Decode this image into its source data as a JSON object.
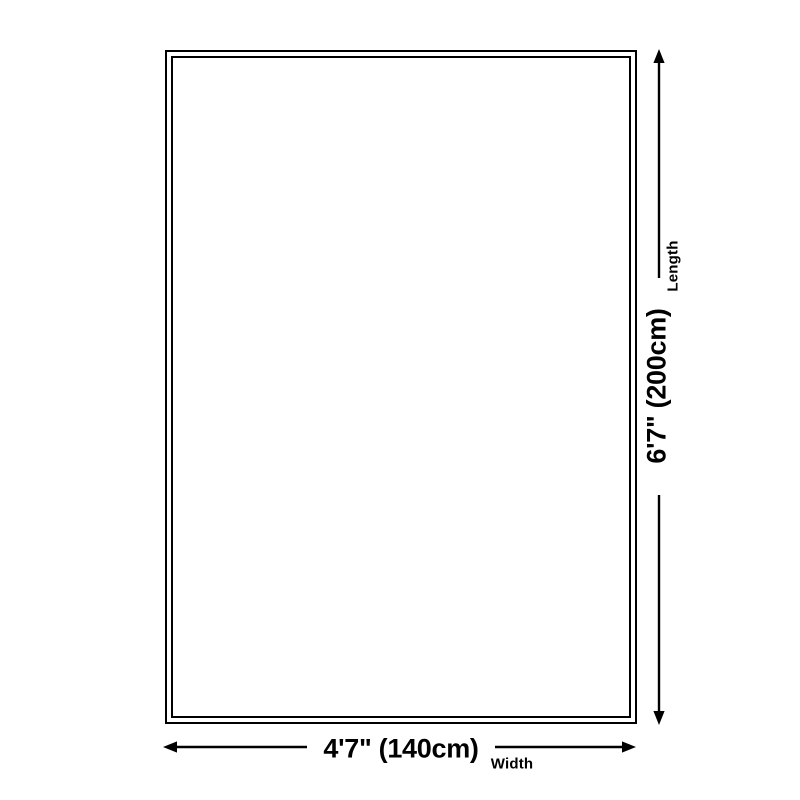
{
  "diagram": {
    "name": "product-size-diagram",
    "length": {
      "value": "6'7\" (200cm)",
      "label": "Length"
    },
    "width": {
      "value": "4'7\" (140cm)",
      "label": "Width"
    },
    "colors": {
      "line": "#000000",
      "background": "#ffffff"
    }
  }
}
